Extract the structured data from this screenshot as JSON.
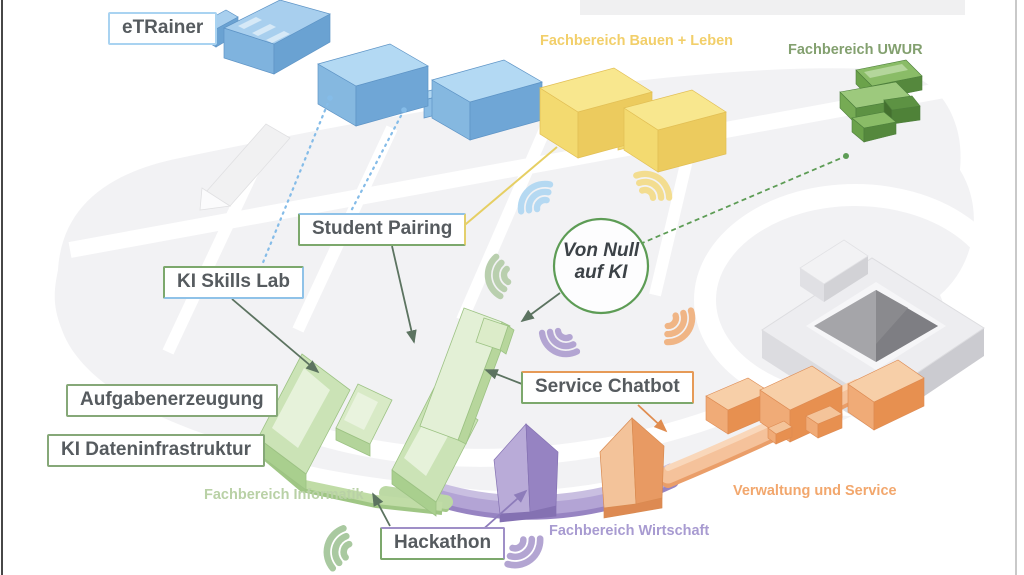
{
  "hub": {
    "line1": "Von Null",
    "line2": "auf KI"
  },
  "projects": {
    "etrainer": "eTRainer",
    "student_pairing": "Student Pairing",
    "ki_skills_lab": "KI Skills Lab",
    "aufgabenerzeugung": "Aufgabenerzeugung",
    "ki_dateninfrastruktur": "KI Dateninfrastruktur",
    "service_chatbot": "Service Chatbot",
    "hackathon": "Hackathon"
  },
  "areas": {
    "bauen_leben": "Fachbereich Bauen + Leben",
    "uwur": "Fachbereich UWUR",
    "informatik": "Fachbereich Informatik",
    "wirtschaft": "Fachbereich Wirtschaft",
    "verwaltung_service": "Verwaltung und Service"
  },
  "palette": {
    "blue_building": "#8bbde5",
    "yellow_building": "#f3da70",
    "green_building_dark": "#6ba24a",
    "green_building_light": "#cbe3b6",
    "purple_road": "#b3a4d5",
    "orange_building": "#f0ab77",
    "gray_building": "#ededf0",
    "ground": "#f2f2f4",
    "hub_ring": "#5d9c55",
    "connector": "#5c7360",
    "area_text_yellow": "#f2cf6a",
    "area_text_green": "#83a06f",
    "area_text_lightgreen": "#b9d1a6",
    "area_text_purple": "#a89bd1",
    "area_text_orange": "#f2a76d",
    "label_text": "#565b5f"
  }
}
